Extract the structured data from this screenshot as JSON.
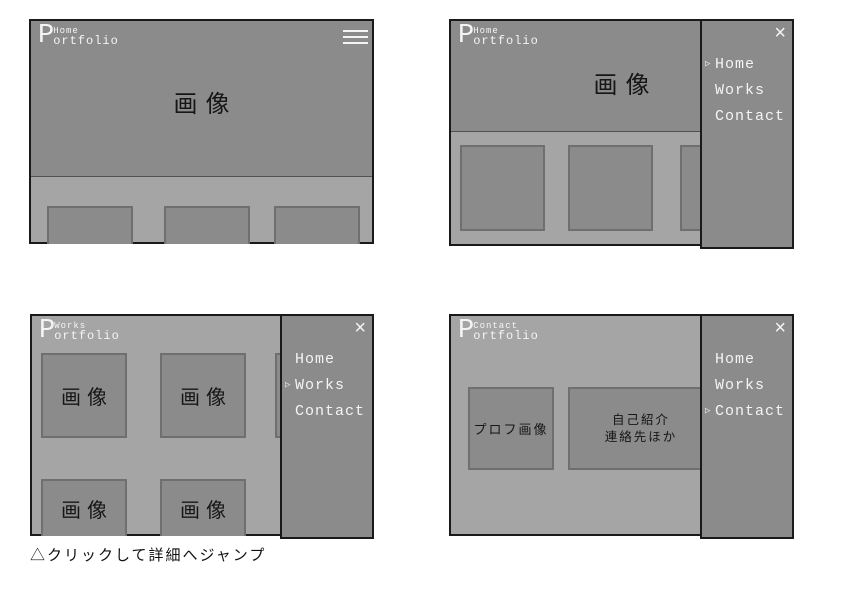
{
  "colors": {
    "gray_dark": "#8b8b8b",
    "gray_light": "#a5a5a5",
    "line": "#1a1a1a",
    "box_border": "#6f6f6f",
    "text_light": "#f4f4f4",
    "text_dark": "#161616"
  },
  "logo": {
    "initial": "P",
    "name_rest": "ortfolio"
  },
  "nav": {
    "items": [
      "Home",
      "Works",
      "Contact"
    ],
    "active_marker": "▷",
    "close_icon": "×"
  },
  "panels": [
    {
      "key": "home-menu-closed",
      "page_label": "Home",
      "hero_label": "画像",
      "menu_open": false
    },
    {
      "key": "home-menu-open",
      "page_label": "Home",
      "hero_label": "画像",
      "menu_open": true,
      "active_item": "Home"
    },
    {
      "key": "works",
      "page_label": "Works",
      "thumbs": [
        "画像",
        "画像",
        "画像",
        "画像"
      ],
      "menu_open": true,
      "active_item": "Works"
    },
    {
      "key": "contact",
      "page_label": "Contact",
      "profile_label": "プロフ画像",
      "about_lines": [
        "自己紹介",
        "連絡先ほか"
      ],
      "menu_open": true,
      "active_item": "Contact"
    }
  ],
  "caption": "△クリックして詳細へジャンプ"
}
